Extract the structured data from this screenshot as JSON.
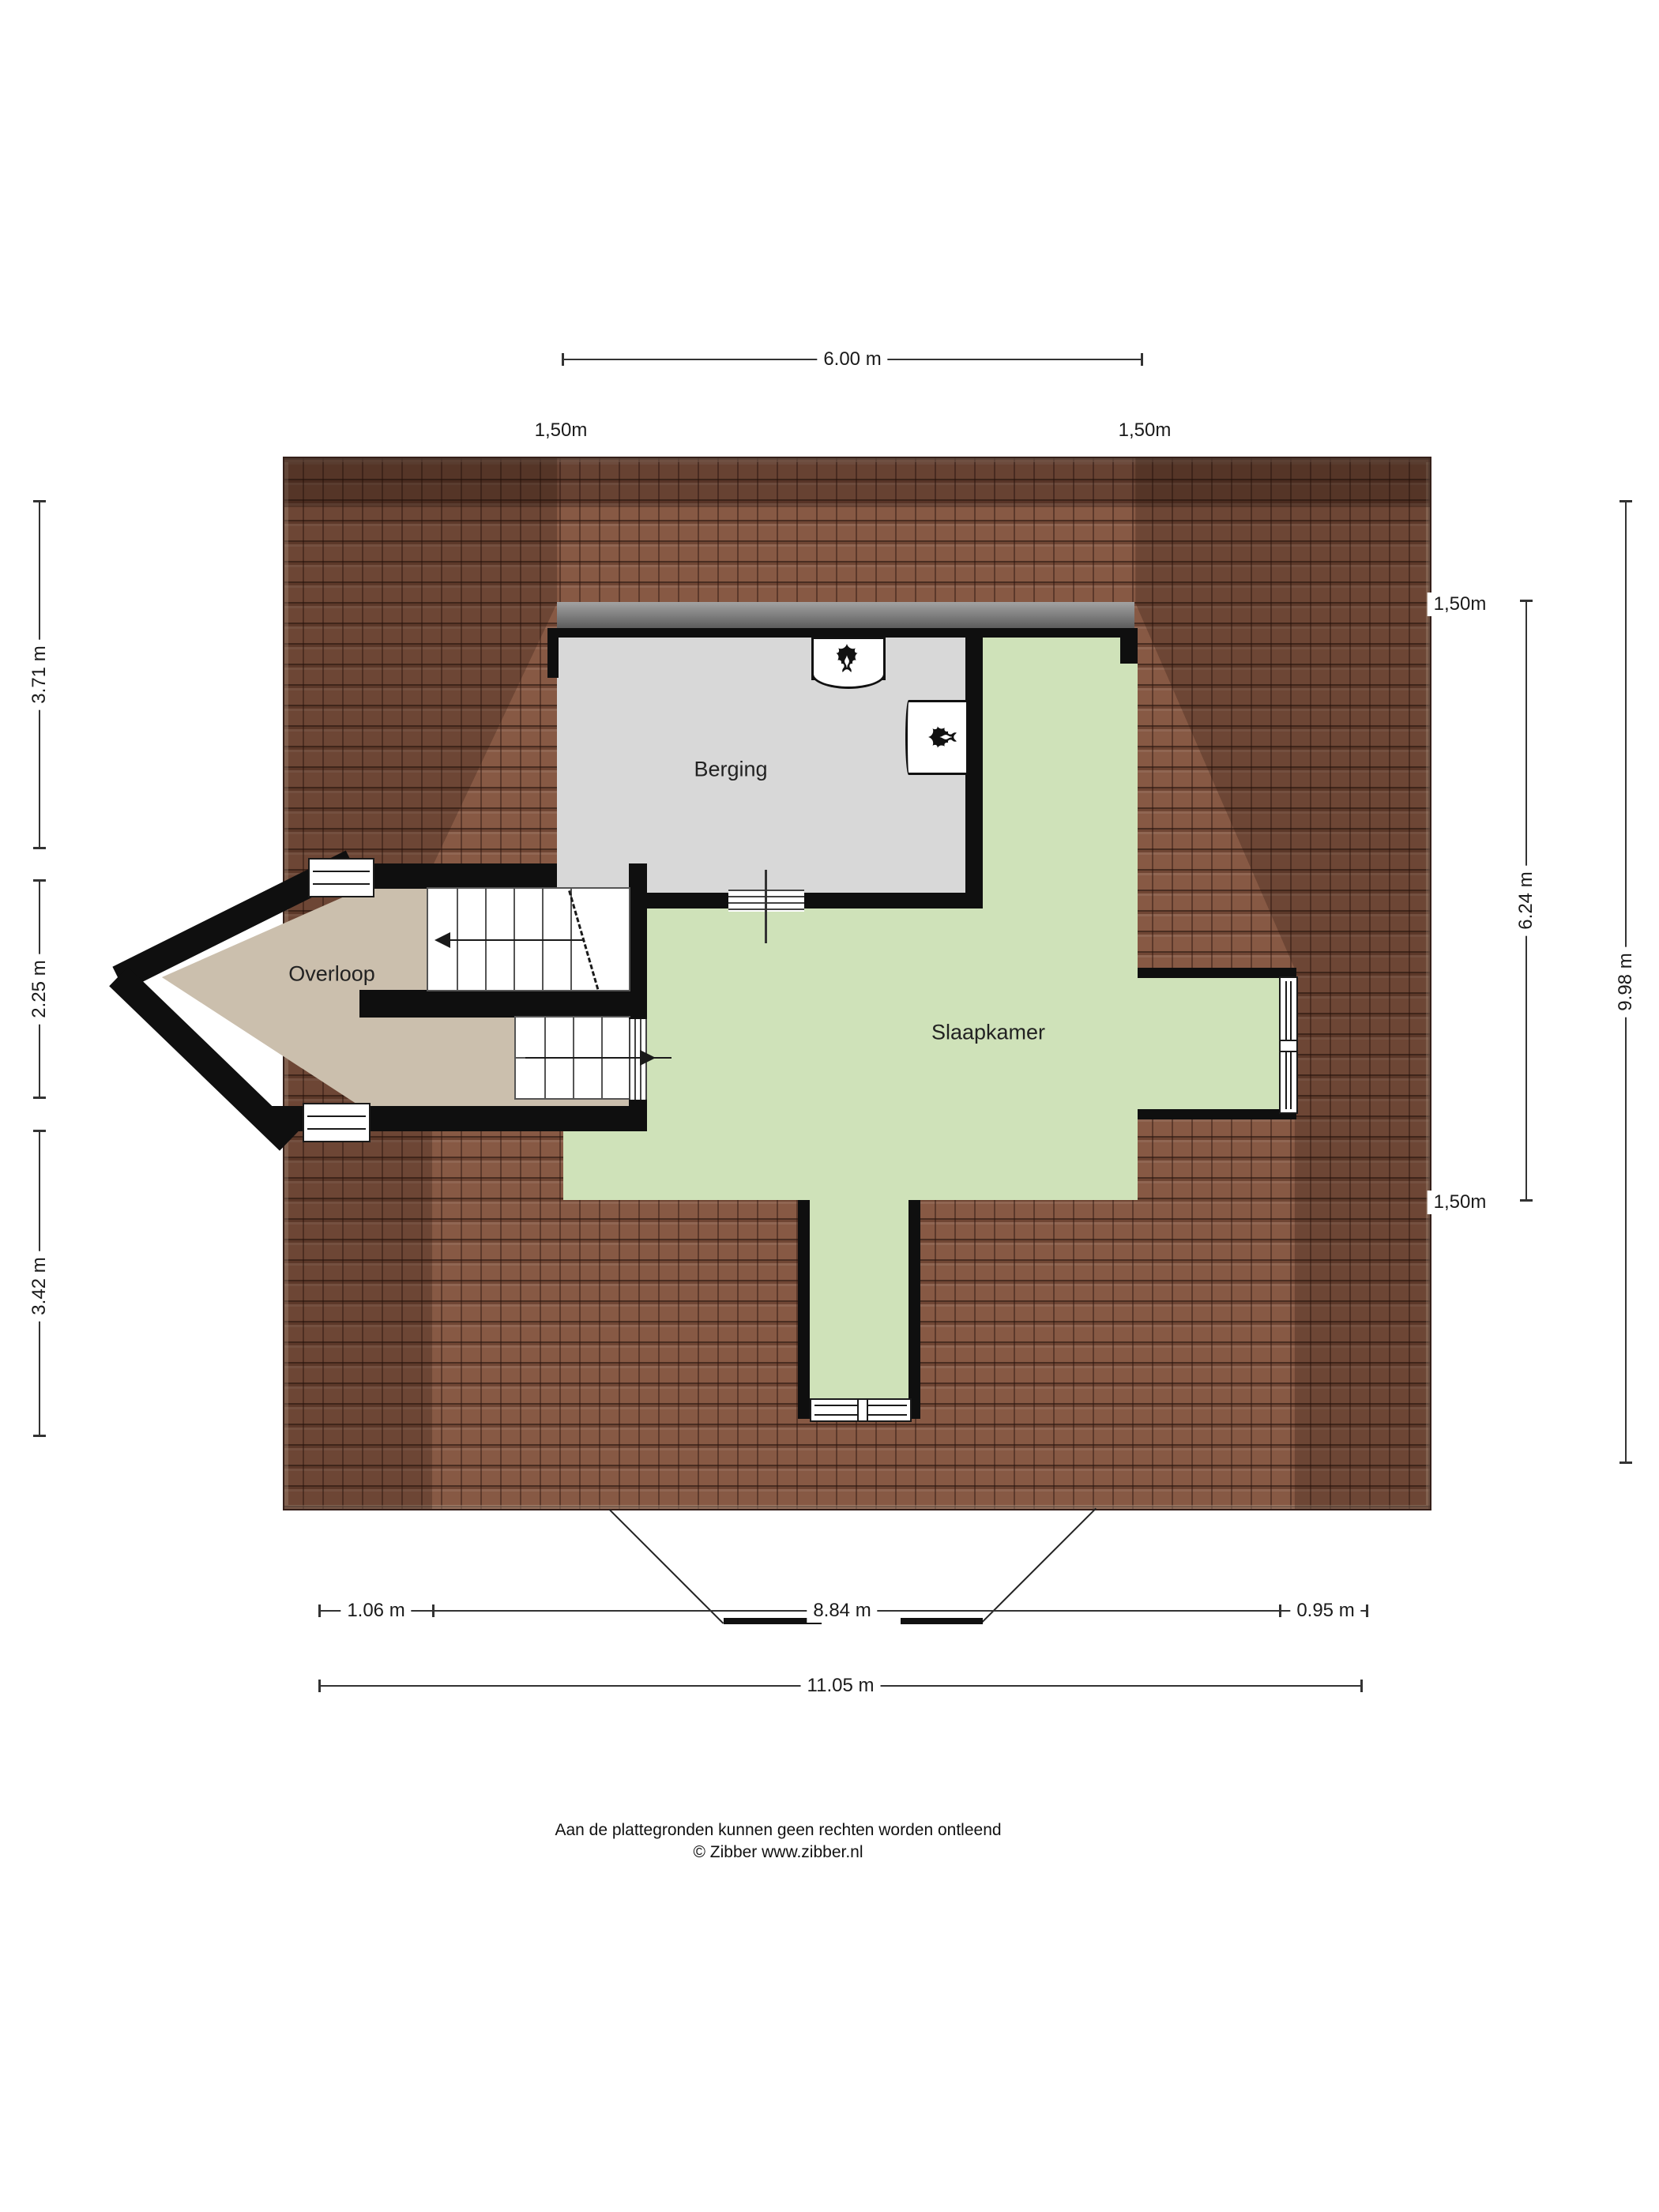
{
  "rooms": {
    "berging": {
      "label": "Berging"
    },
    "overloop": {
      "label": "Overloop"
    },
    "slaapkamer": {
      "label": "Slaapkamer"
    }
  },
  "dimensions": {
    "top": {
      "width": "6.00 m",
      "eave_left": "1,50m",
      "eave_right": "1,50m"
    },
    "left": {
      "upper": "3.71 m",
      "middle": "2.25 m",
      "lower": "3.42 m"
    },
    "right": {
      "eave_top": "1,50m",
      "inner": "6.24 m",
      "total": "9.98 m",
      "eave_bottom": "1,50m"
    },
    "bottom": {
      "left": "1.06 m",
      "middle": "8.84 m",
      "right": "0.95 m",
      "total": "11.05 m"
    }
  },
  "footer": {
    "disclaimer": "Aan de plattegronden kunnen geen rechten worden ontleend",
    "credit": "© Zibber www.zibber.nl"
  },
  "colors": {
    "roof_base": "#875944",
    "wall": "#0f0f0f",
    "floor_berging": "#d8d8d8",
    "floor_overloop": "#cbbfad",
    "floor_slaapkamer": "#cfe2b9",
    "dormer_band": "#7a7a7a"
  },
  "icons": {
    "boiler": "flame-icon"
  }
}
